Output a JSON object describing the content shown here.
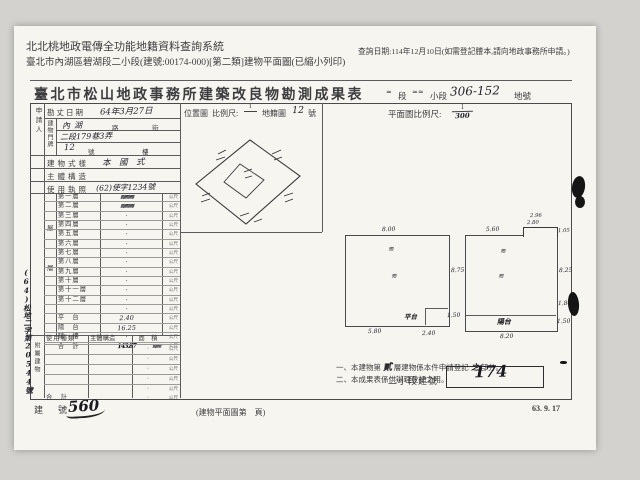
{
  "header": {
    "app_title": "北北桃地政電傳全功能地籍資料查詢系統",
    "doc_line": "臺北市內湖區碧湖段二小段(建號:00174-000)[第二類]建物平面圖(已縮小列印)",
    "query_note": "查詢日期:114年12月10日(如需登記謄本,請向地政事務所申請。)"
  },
  "form": {
    "title": "臺北市松山地政事務所建築改良物勘測成果表",
    "section_row": {
      "duan": "段",
      "xiaoduan": "小段",
      "lot_hand": "306-152",
      "dihao": "地號"
    },
    "plan_scale": {
      "label": "平面圖比例尺:",
      "num": "1",
      "den_hand": "300"
    },
    "location": {
      "label": "位置圖",
      "scale_label": "比例尺:",
      "num": "1",
      "map_label": "地籍圖",
      "map_no_hand": "12",
      "unit": "號"
    },
    "applicant_label": "申請人",
    "survey_row": {
      "label": "勘丈日期",
      "value": "64年3月27日"
    },
    "door_group_label": "建物門牌",
    "door_rows": {
      "r1_hand": "內湖",
      "r1_print1": "路",
      "r1_print2": "街",
      "r2_hand": "二段179巷3弄",
      "r3_hand": "12",
      "r3_print1": "號",
      "r3_print2": "樓"
    },
    "style_row": {
      "label": "建物式樣",
      "value": "本　國　式"
    },
    "structure_row": {
      "label": "主體構造",
      "value": ""
    },
    "license_row": {
      "label": "使用執照",
      "value": "(62)使字1234號"
    },
    "floor_group_chars": {
      "c1": "屋",
      "c2": "層"
    },
    "floors": [
      {
        "label": "第一層",
        "value": "≋≋≋",
        "scrib": true,
        "unit": "公尺"
      },
      {
        "label": "第二層",
        "value": "≋≋≋",
        "scrib": true,
        "unit": "公尺"
      },
      {
        "label": "第三層",
        "value": "·",
        "unit": "公尺"
      },
      {
        "label": "第四層",
        "value": "·",
        "unit": "公尺"
      },
      {
        "label": "第五層",
        "value": "·",
        "unit": "公尺"
      },
      {
        "label": "第六層",
        "value": "·",
        "unit": "公尺"
      },
      {
        "label": "第七層",
        "value": "·",
        "unit": "公尺"
      },
      {
        "label": "第八層",
        "value": "·",
        "unit": "公尺"
      },
      {
        "label": "第九層",
        "value": "·",
        "unit": "公尺"
      },
      {
        "label": "第十層",
        "value": "·",
        "unit": "公尺"
      },
      {
        "label": "第十一層",
        "value": "·",
        "unit": "公尺"
      },
      {
        "label": "第十二層",
        "value": "·",
        "unit": "公尺"
      },
      {
        "label": "",
        "value": "·",
        "unit": "公尺"
      },
      {
        "label": "平　台",
        "value": "2.40",
        "unit": "公尺"
      },
      {
        "label": "陽　台",
        "value": "16.25",
        "unit": "公尺"
      },
      {
        "label": "騎　樓",
        "value": "·",
        "unit": "公尺"
      },
      {
        "label": "合　計",
        "value": "143.87",
        "extra": "≋≋",
        "scrib": true,
        "unit": "公尺"
      }
    ],
    "annex": {
      "group_label": "附屬建物",
      "headers": {
        "h1": "使用種類",
        "h2": "主體構造",
        "h3": "面　積"
      },
      "rows": [
        {
          "c1": "",
          "c2": "",
          "val": "·",
          "unit": "公尺"
        },
        {
          "c1": "",
          "c2": "",
          "val": "·",
          "unit": "公尺"
        },
        {
          "c1": "",
          "c2": "",
          "val": "·",
          "unit": "公尺"
        },
        {
          "c1": "",
          "c2": "",
          "val": "·",
          "unit": "公尺"
        },
        {
          "c1": "",
          "c2": "",
          "val": "·",
          "unit": "公尺"
        }
      ],
      "total_row": {
        "c1": "合　計",
        "val": "·",
        "unit": "公尺"
      }
    },
    "margin_note_hand": "(64)松地二字第20544號",
    "plans": {
      "left": {
        "top": "8.00",
        "right": "8.75",
        "bottom_left": "5.80",
        "bottom_mid": "2.40",
        "notch": "1.50",
        "stamp": "平台",
        "scribble1": "≋",
        "scribble2": "≋"
      },
      "right": {
        "top_left": "5.60",
        "notch_top2": "2.96",
        "notch_top": "2.80",
        "notch_right": "1.05",
        "right": "8.25",
        "mid_right": "1.84",
        "low_right": "1.50",
        "bottom": "8.20",
        "stamp": "陽台",
        "scribble1": "≋",
        "scribble2": "≋"
      }
    },
    "notes": {
      "n1_pre": "一、本建物第",
      "n1_hand": "貳",
      "n1_mid": "層建物係本件申請登記",
      "n1_hand2": "之",
      "n1_post": "部分。",
      "n2": "二、本成果表係供辦理登記之用。"
    },
    "subsection": {
      "label": "二小段建號",
      "value_hand": "174"
    },
    "footer": {
      "jianhao_label": "建　號",
      "jianhao_value": "560",
      "page_note": "(建物平面圖第　頁)",
      "version_date": "63. 9. 17"
    }
  }
}
